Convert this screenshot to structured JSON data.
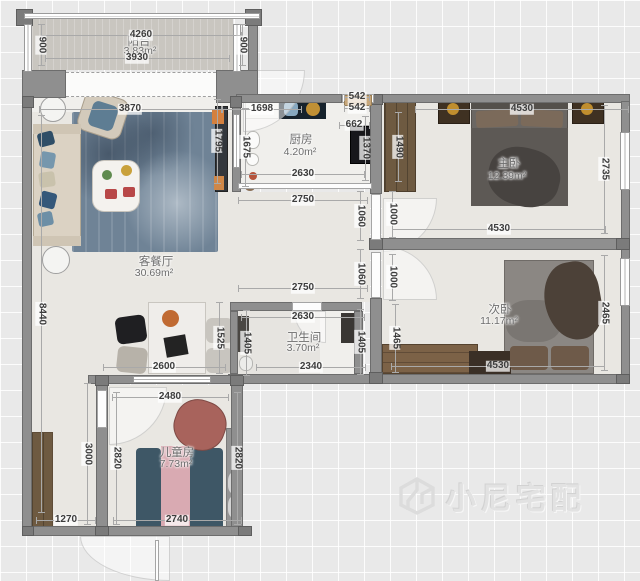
{
  "watermark": {
    "text": "小尼宅配",
    "logo": "cube-logo"
  },
  "rooms": [
    {
      "id": "balcony",
      "name": "阳台",
      "area": "3.83m²",
      "nx": 139,
      "ny": 41,
      "ax": 140,
      "ay": 51
    },
    {
      "id": "kitchen",
      "name": "厨房",
      "area": "4.20m²",
      "nx": 301,
      "ny": 139,
      "ax": 300,
      "ay": 152
    },
    {
      "id": "master-bedroom",
      "name": "主卧",
      "area": "12.39m²",
      "nx": 509,
      "ny": 163,
      "ax": 507,
      "ay": 176
    },
    {
      "id": "second-bedroom",
      "name": "次卧",
      "area": "11.17m²",
      "nx": 500,
      "ny": 309,
      "ax": 499,
      "ay": 321
    },
    {
      "id": "living-dining",
      "name": "客餐厅",
      "area": "30.69m²",
      "nx": 156,
      "ny": 261,
      "ax": 154,
      "ay": 273
    },
    {
      "id": "bathroom",
      "name": "卫生间",
      "area": "3.70m²",
      "nx": 304,
      "ny": 337,
      "ax": 303,
      "ay": 348
    },
    {
      "id": "kids-room",
      "name": "儿童房",
      "area": "7.73m²",
      "nx": 177,
      "ny": 452,
      "ax": 176,
      "ay": 464
    }
  ],
  "dimensions": [
    {
      "v": "4260",
      "x": 141,
      "y": 35,
      "o": "h"
    },
    {
      "v": "3930",
      "x": 137,
      "y": 58,
      "o": "h"
    },
    {
      "v": "900",
      "x": 41,
      "y": 45,
      "o": "v"
    },
    {
      "v": "900",
      "x": 242,
      "y": 45,
      "o": "v"
    },
    {
      "v": "3870",
      "x": 130,
      "y": 109,
      "o": "h"
    },
    {
      "v": "1698",
      "x": 262,
      "y": 109,
      "o": "h"
    },
    {
      "v": "542",
      "x": 357,
      "y": 97,
      "o": "h"
    },
    {
      "v": "542",
      "x": 357,
      "y": 108,
      "o": "h"
    },
    {
      "v": "662",
      "x": 354,
      "y": 125,
      "o": "h"
    },
    {
      "v": "4530",
      "x": 522,
      "y": 109,
      "o": "h"
    },
    {
      "v": "1370",
      "x": 365,
      "y": 148,
      "o": "v"
    },
    {
      "v": "1490",
      "x": 398,
      "y": 147,
      "o": "v"
    },
    {
      "v": "1795",
      "x": 217,
      "y": 141,
      "o": "v"
    },
    {
      "v": "1675",
      "x": 245,
      "y": 147,
      "o": "v"
    },
    {
      "v": "2735",
      "x": 604,
      "y": 169,
      "o": "v"
    },
    {
      "v": "2630",
      "x": 303,
      "y": 174,
      "o": "h"
    },
    {
      "v": "2750",
      "x": 303,
      "y": 200,
      "o": "h"
    },
    {
      "v": "1060",
      "x": 360,
      "y": 216,
      "o": "v"
    },
    {
      "v": "1000",
      "x": 392,
      "y": 214,
      "o": "v"
    },
    {
      "v": "4530",
      "x": 499,
      "y": 229,
      "o": "h"
    },
    {
      "v": "8440",
      "x": 41,
      "y": 314,
      "o": "v"
    },
    {
      "v": "1060",
      "x": 360,
      "y": 274,
      "o": "v"
    },
    {
      "v": "1000",
      "x": 392,
      "y": 277,
      "o": "v"
    },
    {
      "v": "2750",
      "x": 303,
      "y": 288,
      "o": "h"
    },
    {
      "v": "2630",
      "x": 303,
      "y": 317,
      "o": "h"
    },
    {
      "v": "2465",
      "x": 604,
      "y": 313,
      "o": "v"
    },
    {
      "v": "1525",
      "x": 219,
      "y": 338,
      "o": "v"
    },
    {
      "v": "1405",
      "x": 246,
      "y": 343,
      "o": "v"
    },
    {
      "v": "1405",
      "x": 360,
      "y": 342,
      "o": "v"
    },
    {
      "v": "1465",
      "x": 395,
      "y": 338,
      "o": "v"
    },
    {
      "v": "2600",
      "x": 164,
      "y": 367,
      "o": "h"
    },
    {
      "v": "2340",
      "x": 311,
      "y": 367,
      "o": "h"
    },
    {
      "v": "4530",
      "x": 498,
      "y": 366,
      "o": "h"
    },
    {
      "v": "2480",
      "x": 170,
      "y": 397,
      "o": "h"
    },
    {
      "v": "3000",
      "x": 87,
      "y": 454,
      "o": "v"
    },
    {
      "v": "2820",
      "x": 116,
      "y": 458,
      "o": "v"
    },
    {
      "v": "2820",
      "x": 237,
      "y": 458,
      "o": "v"
    },
    {
      "v": "2740",
      "x": 177,
      "y": 520,
      "o": "h"
    },
    {
      "v": "1270",
      "x": 66,
      "y": 520,
      "o": "h"
    }
  ]
}
